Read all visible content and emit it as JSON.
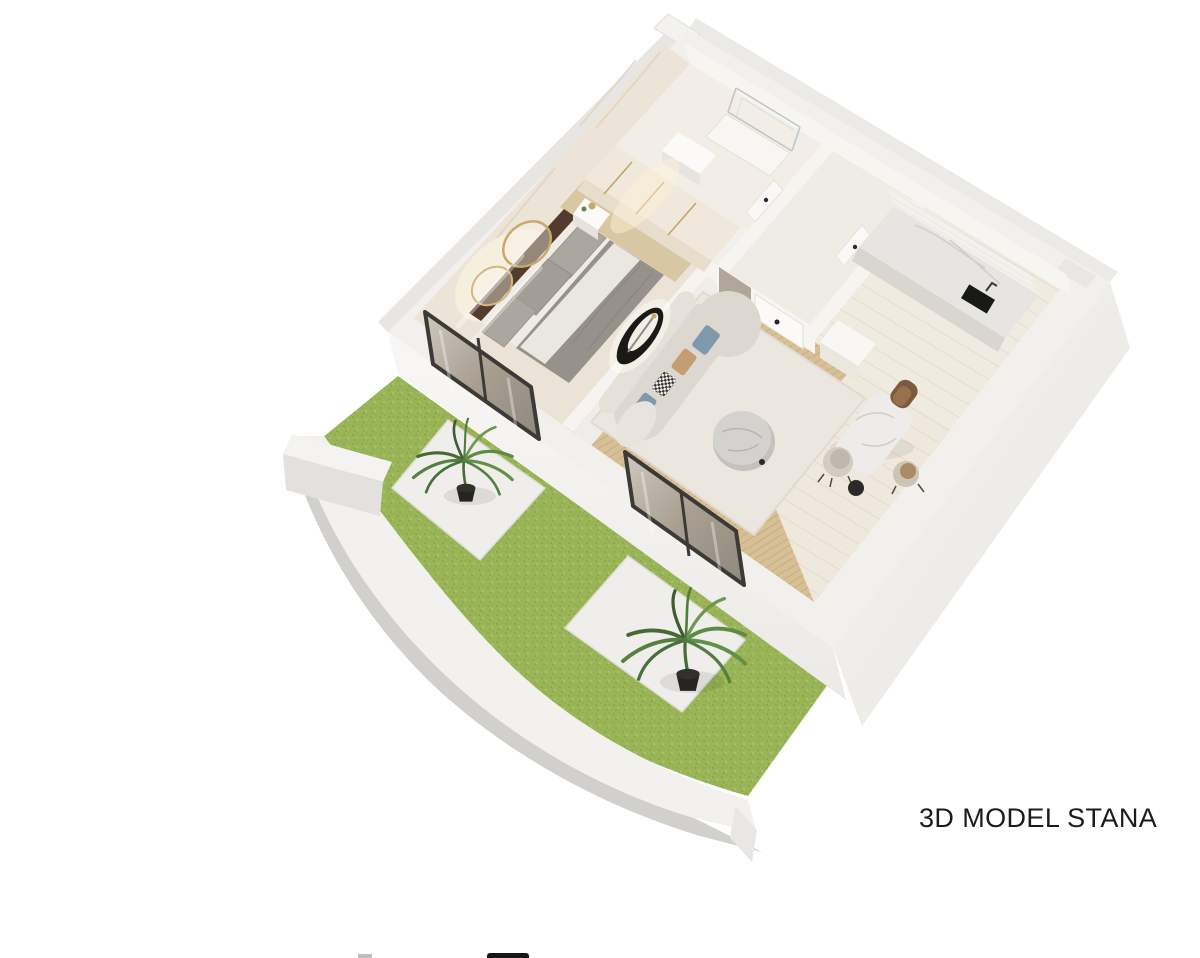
{
  "caption": {
    "text": "3D MODEL STANA",
    "color": "#1b1b1b"
  },
  "scene": {
    "type": "architectural-3d-floor-plan-render",
    "rooms": [
      "bathroom",
      "entry-hall",
      "kitchen",
      "bedroom",
      "living-dining",
      "terrace-garden"
    ],
    "elements": [
      "grass-lawn",
      "curved-parapet-wall",
      "patio-paving",
      "palm-plants",
      "bedroom-bed",
      "ring-mirrors",
      "wardrobe",
      "nightstand",
      "curved-sofa",
      "coffee-table",
      "area-rug",
      "oval-wall-sconce",
      "dining-table",
      "dining-chairs",
      "kitchen-counter",
      "kitchen-sink",
      "shower-enclosure",
      "interior-doors",
      "terrace-windows"
    ],
    "palette": {
      "background": "#ffffff",
      "wall_top": "#f1f0ed",
      "wall_face": "#eceae6",
      "wall_shadow": "#d7d5d1",
      "inner_wall_cream": "#ece4d6",
      "wood_floor": "#d8c096",
      "kitchen_floor": "#f0ebe1",
      "bedroom_floor": "#ebe3d6",
      "rug": "#ebe6de",
      "grass": "#9ab557",
      "plant_dark": "#3f5c33",
      "plant_light": "#6e9850",
      "window_frame": "#3c3a36",
      "headboard": "#523c2d",
      "bed_gray": "#96918a",
      "sofa": "#dcd8d0",
      "pillow_blue": "#7e99ac",
      "pillow_tan": "#c59d72",
      "marble": "#ccc9c5",
      "counter_marble": "#e6e5e2",
      "sink": "#191918",
      "brass": "#c9a86b",
      "taupe_panel": "#b0a79a",
      "caption_text": "#1b1b1b"
    }
  },
  "footer_marks": {
    "count": 2
  }
}
